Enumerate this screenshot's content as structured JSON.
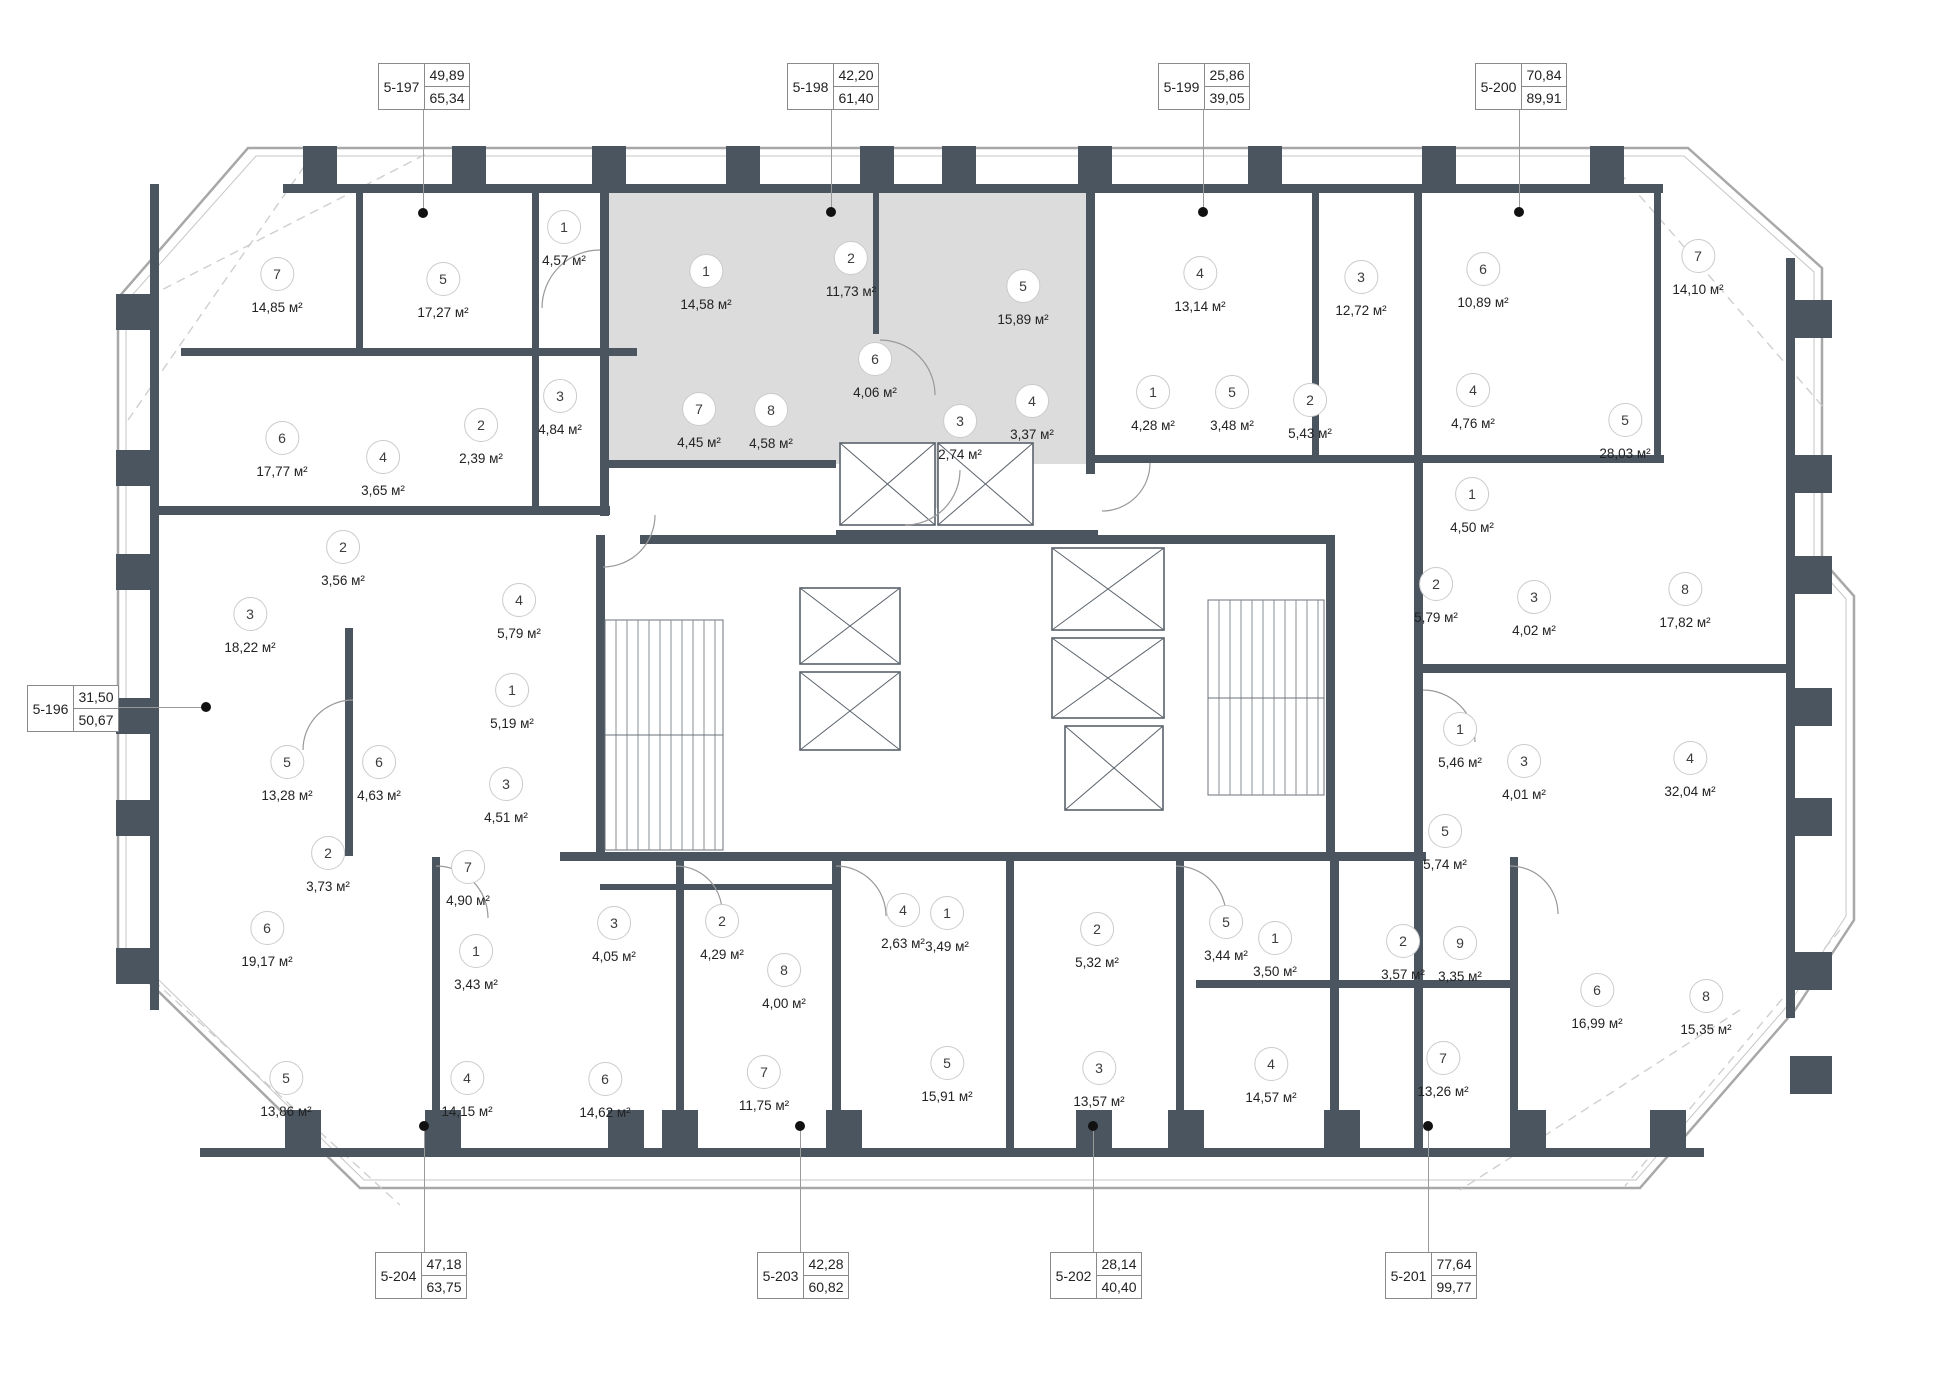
{
  "plan": {
    "colors": {
      "wall": "#4b5560",
      "shade": "#dcdcdc",
      "facade": "#a8a8a8",
      "accent_dot": "#111111"
    },
    "units": [
      {
        "id": "5-197",
        "upper": "49,89",
        "lower": "65,34",
        "box": [
          378,
          63
        ],
        "dot": [
          423,
          213
        ],
        "dir": "down"
      },
      {
        "id": "5-198",
        "upper": "42,20",
        "lower": "61,40",
        "box": [
          787,
          63
        ],
        "dot": [
          831,
          212
        ],
        "dir": "down"
      },
      {
        "id": "5-199",
        "upper": "25,86",
        "lower": "39,05",
        "box": [
          1158,
          63
        ],
        "dot": [
          1203,
          212
        ],
        "dir": "down"
      },
      {
        "id": "5-200",
        "upper": "70,84",
        "lower": "89,91",
        "box": [
          1475,
          63
        ],
        "dot": [
          1519,
          212
        ],
        "dir": "down"
      },
      {
        "id": "5-196",
        "upper": "31,50",
        "lower": "50,67",
        "box": [
          27,
          685
        ],
        "dot": [
          206,
          707
        ],
        "dir": "right"
      },
      {
        "id": "5-204",
        "upper": "47,18",
        "lower": "63,75",
        "box": [
          375,
          1252
        ],
        "dot": [
          424,
          1126
        ],
        "dir": "up"
      },
      {
        "id": "5-203",
        "upper": "42,28",
        "lower": "60,82",
        "box": [
          757,
          1252
        ],
        "dot": [
          800,
          1126
        ],
        "dir": "up"
      },
      {
        "id": "5-202",
        "upper": "28,14",
        "lower": "40,40",
        "box": [
          1050,
          1252
        ],
        "dot": [
          1093,
          1126
        ],
        "dir": "up"
      },
      {
        "id": "5-201",
        "upper": "77,64",
        "lower": "99,77",
        "box": [
          1385,
          1252
        ],
        "dot": [
          1428,
          1126
        ],
        "dir": "up"
      }
    ],
    "rooms": [
      {
        "n": "7",
        "a": "14,85 м²",
        "x": 277,
        "y": 273
      },
      {
        "n": "5",
        "a": "17,27 м²",
        "x": 443,
        "y": 278
      },
      {
        "n": "1",
        "a": "4,57 м²",
        "x": 564,
        "y": 226
      },
      {
        "n": "3",
        "a": "4,84 м²",
        "x": 560,
        "y": 395
      },
      {
        "n": "2",
        "a": "2,39 м²",
        "x": 481,
        "y": 424
      },
      {
        "n": "4",
        "a": "3,65 м²",
        "x": 383,
        "y": 456
      },
      {
        "n": "6",
        "a": "17,77 м²",
        "x": 282,
        "y": 437
      },
      {
        "n": "1",
        "a": "14,58 м²",
        "x": 706,
        "y": 270
      },
      {
        "n": "2",
        "a": "11,73 м²",
        "x": 851,
        "y": 257
      },
      {
        "n": "5",
        "a": "15,89 м²",
        "x": 1023,
        "y": 285
      },
      {
        "n": "6",
        "a": "4,06 м²",
        "x": 875,
        "y": 358
      },
      {
        "n": "7",
        "a": "4,45 м²",
        "x": 699,
        "y": 408
      },
      {
        "n": "8",
        "a": "4,58 м²",
        "x": 771,
        "y": 409
      },
      {
        "n": "3",
        "a": "2,74 м²",
        "x": 960,
        "y": 420
      },
      {
        "n": "4",
        "a": "3,37 м²",
        "x": 1032,
        "y": 400
      },
      {
        "n": "4",
        "a": "13,14 м²",
        "x": 1200,
        "y": 272
      },
      {
        "n": "1",
        "a": "4,28 м²",
        "x": 1153,
        "y": 391
      },
      {
        "n": "5",
        "a": "3,48 м²",
        "x": 1232,
        "y": 391
      },
      {
        "n": "3",
        "a": "12,72 м²",
        "x": 1361,
        "y": 276
      },
      {
        "n": "2",
        "a": "5,43 м²",
        "x": 1310,
        "y": 399
      },
      {
        "n": "6",
        "a": "10,89 м²",
        "x": 1483,
        "y": 268
      },
      {
        "n": "4",
        "a": "4,76 м²",
        "x": 1473,
        "y": 389
      },
      {
        "n": "7",
        "a": "14,10 м²",
        "x": 1698,
        "y": 255
      },
      {
        "n": "5",
        "a": "28,03 м²",
        "x": 1625,
        "y": 419
      },
      {
        "n": "1",
        "a": "4,50 м²",
        "x": 1472,
        "y": 493
      },
      {
        "n": "2",
        "a": "5,79 м²",
        "x": 1436,
        "y": 583
      },
      {
        "n": "3",
        "a": "4,02 м²",
        "x": 1534,
        "y": 596
      },
      {
        "n": "8",
        "a": "17,82 м²",
        "x": 1685,
        "y": 588
      },
      {
        "n": "2",
        "a": "3,56 м²",
        "x": 343,
        "y": 546
      },
      {
        "n": "3",
        "a": "18,22 м²",
        "x": 250,
        "y": 613
      },
      {
        "n": "4",
        "a": "5,79 м²",
        "x": 519,
        "y": 599
      },
      {
        "n": "1",
        "a": "5,19 м²",
        "x": 512,
        "y": 689
      },
      {
        "n": "5",
        "a": "13,28 м²",
        "x": 287,
        "y": 761
      },
      {
        "n": "6",
        "a": "4,63 м²",
        "x": 379,
        "y": 761
      },
      {
        "n": "3",
        "a": "4,51 м²",
        "x": 506,
        "y": 783
      },
      {
        "n": "2",
        "a": "3,73 м²",
        "x": 328,
        "y": 852
      },
      {
        "n": "7",
        "a": "4,90 м²",
        "x": 468,
        "y": 866
      },
      {
        "n": "6",
        "a": "19,17 м²",
        "x": 267,
        "y": 927
      },
      {
        "n": "1",
        "a": "3,43 м²",
        "x": 476,
        "y": 950
      },
      {
        "n": "5",
        "a": "13,86 м²",
        "x": 286,
        "y": 1077
      },
      {
        "n": "4",
        "a": "14,15 м²",
        "x": 467,
        "y": 1077
      },
      {
        "n": "3",
        "a": "4,05 м²",
        "x": 614,
        "y": 922
      },
      {
        "n": "2",
        "a": "4,29 м²",
        "x": 722,
        "y": 920
      },
      {
        "n": "8",
        "a": "4,00 м²",
        "x": 784,
        "y": 969
      },
      {
        "n": "4",
        "a": "2,63 м²",
        "x": 903,
        "y": 909
      },
      {
        "n": "1",
        "a": "3,49 м²",
        "x": 947,
        "y": 912
      },
      {
        "n": "6",
        "a": "14,62 м²",
        "x": 605,
        "y": 1078
      },
      {
        "n": "7",
        "a": "11,75 м²",
        "x": 764,
        "y": 1071
      },
      {
        "n": "5",
        "a": "15,91 м²",
        "x": 947,
        "y": 1062
      },
      {
        "n": "2",
        "a": "5,32 м²",
        "x": 1097,
        "y": 928
      },
      {
        "n": "5",
        "a": "3,44 м²",
        "x": 1226,
        "y": 921
      },
      {
        "n": "1",
        "a": "3,50 м²",
        "x": 1275,
        "y": 937
      },
      {
        "n": "3",
        "a": "13,57 м²",
        "x": 1099,
        "y": 1067
      },
      {
        "n": "4",
        "a": "14,57 м²",
        "x": 1271,
        "y": 1063
      },
      {
        "n": "2",
        "a": "3,57 м²",
        "x": 1403,
        "y": 940
      },
      {
        "n": "9",
        "a": "3,35 м²",
        "x": 1460,
        "y": 942
      },
      {
        "n": "1",
        "a": "5,46 м²",
        "x": 1460,
        "y": 728
      },
      {
        "n": "3",
        "a": "4,01 м²",
        "x": 1524,
        "y": 760
      },
      {
        "n": "4",
        "a": "32,04 м²",
        "x": 1690,
        "y": 757
      },
      {
        "n": "5",
        "a": "5,74 м²",
        "x": 1445,
        "y": 830
      },
      {
        "n": "6",
        "a": "16,99 м²",
        "x": 1597,
        "y": 989
      },
      {
        "n": "8",
        "a": "15,35 м²",
        "x": 1706,
        "y": 995
      },
      {
        "n": "7",
        "a": "13,26 м²",
        "x": 1443,
        "y": 1057
      }
    ]
  }
}
